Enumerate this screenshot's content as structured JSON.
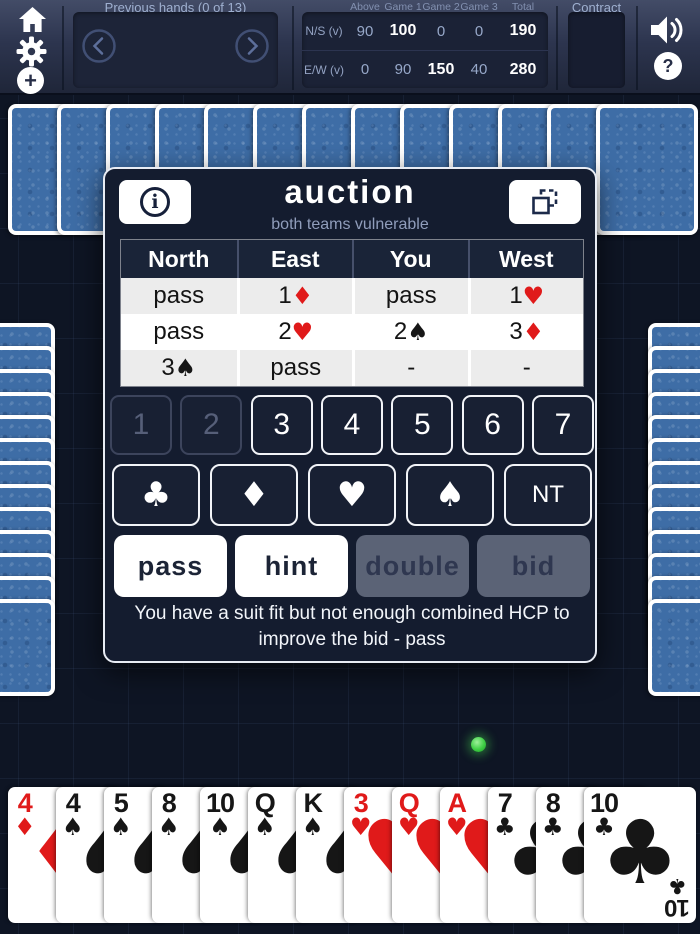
{
  "topbar": {
    "previous_hands_label": "Previous hands (0 of 13)",
    "contract_label": "Contract",
    "score": {
      "col_headers": [
        "Above",
        "Game 1",
        "Game 2",
        "Game 3",
        "Total"
      ],
      "rows": [
        {
          "label": "N/S (v)",
          "values": [
            "90",
            "100",
            "0",
            "0",
            "190"
          ],
          "bright": [
            false,
            true,
            false,
            false,
            true
          ]
        },
        {
          "label": "E/W (v)",
          "values": [
            "0",
            "90",
            "150",
            "40",
            "280"
          ],
          "bright": [
            false,
            false,
            true,
            false,
            true
          ]
        }
      ]
    }
  },
  "icons": {
    "home": "house-shape",
    "gear": "settings-gear",
    "plus": "+",
    "speaker": "volume-waves",
    "question": "?",
    "info": "i",
    "expand": "copy-frame-dashed",
    "prev": "chevron-left",
    "next": "chevron-right"
  },
  "auction": {
    "title": "auction",
    "subtitle": "both teams vulnerable",
    "seats": [
      "North",
      "East",
      "You",
      "West"
    ],
    "bids": [
      [
        "pass",
        "1♦",
        "pass",
        "1♥"
      ],
      [
        "pass",
        "2♥",
        "2♠",
        "3♦"
      ],
      [
        "3♠",
        "pass",
        "-",
        "-"
      ]
    ],
    "levels": [
      {
        "label": "1",
        "enabled": false
      },
      {
        "label": "2",
        "enabled": false
      },
      {
        "label": "3",
        "enabled": true
      },
      {
        "label": "4",
        "enabled": true
      },
      {
        "label": "5",
        "enabled": true
      },
      {
        "label": "6",
        "enabled": true
      },
      {
        "label": "7",
        "enabled": true
      }
    ],
    "suit_buttons": [
      "♣",
      "♦",
      "♥",
      "♠",
      "NT"
    ],
    "actions": [
      {
        "label": "pass",
        "enabled": true
      },
      {
        "label": "hint",
        "enabled": true
      },
      {
        "label": "double",
        "enabled": false
      },
      {
        "label": "bid",
        "enabled": false
      }
    ],
    "hint_text": "You have a suit fit but not enough combined HCP to improve the bid - pass"
  },
  "hand": {
    "cards": [
      "4♦",
      "4♠",
      "5♠",
      "8♠",
      "10♠",
      "Q♠",
      "K♠",
      "3♥",
      "Q♥",
      "A♥",
      "7♣",
      "8♣",
      "10♣"
    ]
  },
  "opponents": {
    "north_cards": 13,
    "left_cards": 13,
    "right_cards": 13
  },
  "colors": {
    "red_suit": "#e01a1a",
    "black_suit": "#161616",
    "card_back": "#3e6da6",
    "green_marker": "#3ecf44"
  }
}
